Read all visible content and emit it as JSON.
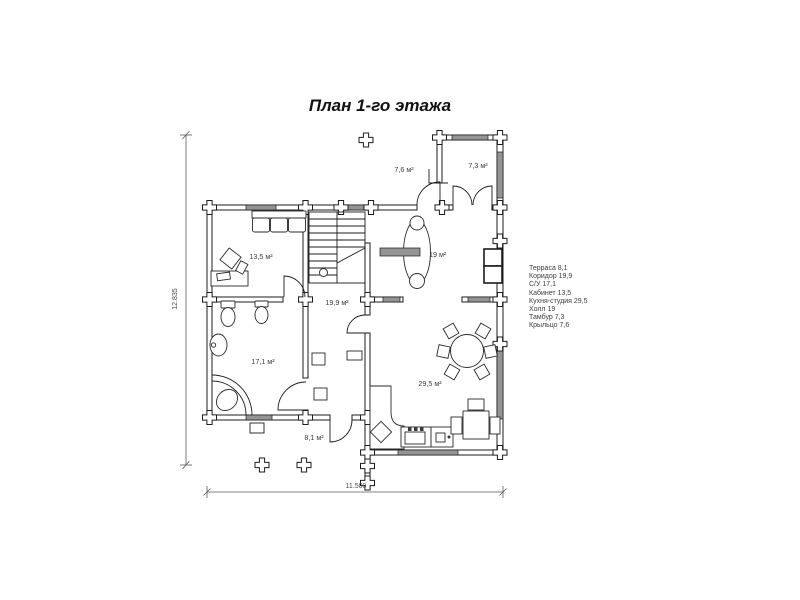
{
  "title": "План 1-го этажа",
  "legend": {
    "items": [
      "Терраса 8,1",
      "Коридор 19,9",
      "С/У 17,1",
      "Кабинет 13,5",
      "Кухня-студия 29,5",
      "Холл 19",
      "Тамбур 7,3",
      "Крыльцо 7,6"
    ]
  },
  "rooms": {
    "porch": "7,6 м²",
    "tambour": "7,3 м²",
    "office": "13,5 м²",
    "hall": "19 м²",
    "corridor": "19,9 м²",
    "bathroom": "17,1 м²",
    "kitchen": "29,5 м²",
    "terrace": "8,1 м²"
  },
  "dimensions": {
    "width": "11.500",
    "height": "12.835"
  },
  "colors": {
    "wall_line": "#1c1c1c",
    "window_fill": "#949494",
    "label_text": "#3d3d3d",
    "background": "#ffffff"
  }
}
